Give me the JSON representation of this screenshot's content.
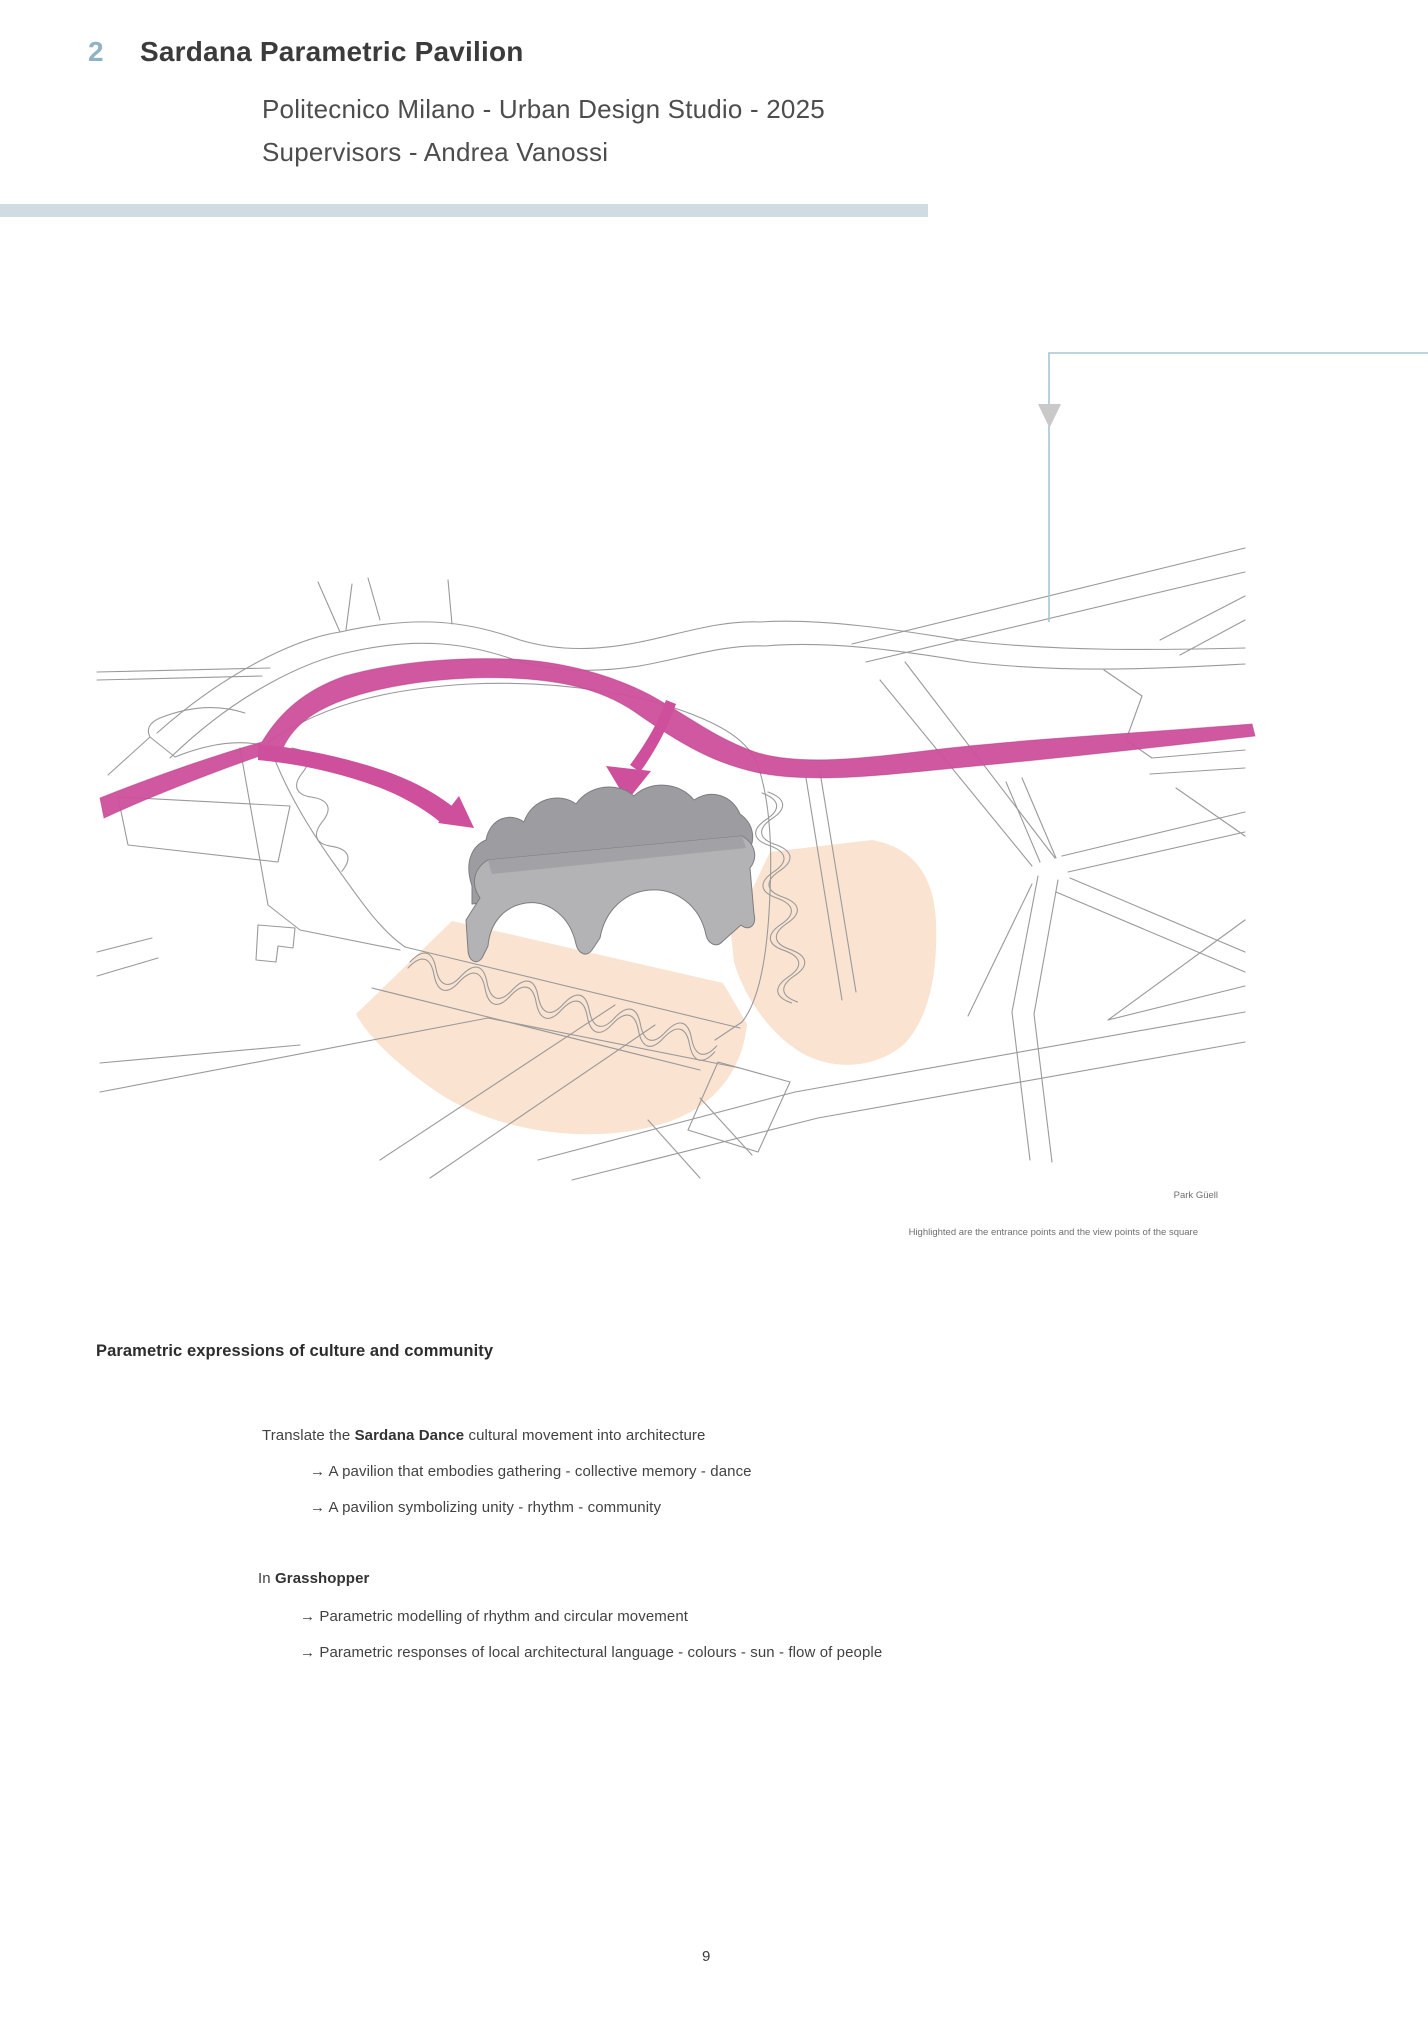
{
  "header": {
    "chapter_number": "2",
    "title": "Sardana Parametric Pavilion",
    "subtitle_line1": "Politecnico Milano - Urban Design Studio - 2025",
    "subtitle_line2": "Supervisors - Andrea Vanossi"
  },
  "figure": {
    "location_label": "Park Güell",
    "caption": "Highlighted are the entrance points and the view points of the square"
  },
  "content": {
    "section_heading": "Parametric expressions of culture and community",
    "block1": {
      "intro_prefix": "Translate the ",
      "intro_bold": "Sardana Dance",
      "intro_suffix": " cultural movement into architecture",
      "items": [
        "→ A pavilion that embodies gathering - collective memory - dance",
        "→ A pavilion symbolizing unity - rhythm - community"
      ]
    },
    "block2": {
      "intro_prefix": "In ",
      "intro_bold": "Grasshopper",
      "intro_suffix": "",
      "items": [
        "→ Parametric modelling of rhythm and circular movement",
        "→ Parametric responses of local architectural language - colours - sun - flow of people"
      ]
    }
  },
  "page": {
    "number": "9"
  },
  "colors": {
    "accent_blue": "#8fb3c3",
    "divider_bar": "#cfdde3",
    "callout_line": "#a5c6d2",
    "flow_pink": "#ce4f9b",
    "highlight_peach": "#fbe3d1",
    "pavilion_gray": "#b3b3b6",
    "road_gray": "#9a9a9a"
  }
}
